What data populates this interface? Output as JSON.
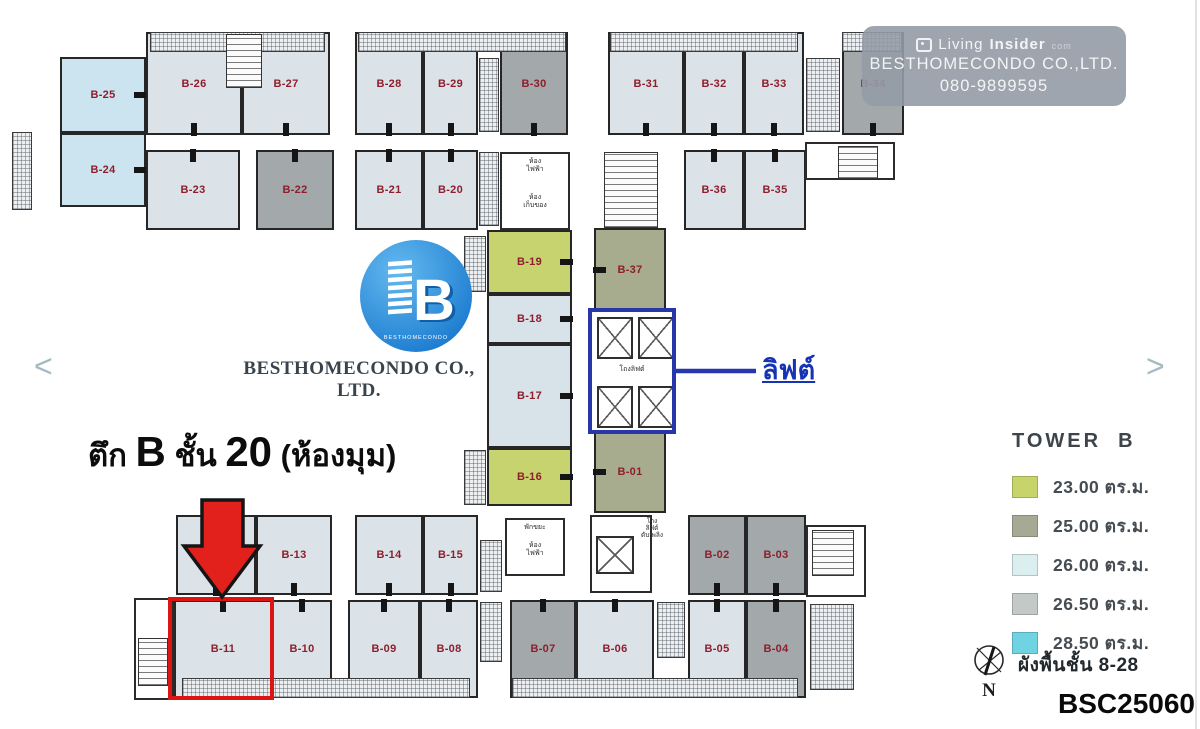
{
  "watermark": {
    "brand_regular": "Living",
    "brand_bold": "Insider",
    "brand_suffix": "com",
    "company": "BESTHOMECONDO CO.,LTD.",
    "phone": "080-9899595"
  },
  "logo": {
    "letter": "B",
    "brand_small": "BESTHOMECONDO",
    "company": "BESTHOMECONDO CO., LTD."
  },
  "heading": {
    "t1": "ตึก ",
    "t2": "B",
    "t3": " ชั้น ",
    "t4": "20",
    "t5": " (ห้องมุม)"
  },
  "elevator_callout": {
    "label": "ลิฟต์"
  },
  "legend": {
    "title": "TOWER  B",
    "items": [
      {
        "color": "#c7d36b",
        "label": "23.00 ตร.ม."
      },
      {
        "color": "#a6aa94",
        "label": "25.00 ตร.ม."
      },
      {
        "color": "#dbeef0",
        "label": "26.00 ตร.ม."
      },
      {
        "color": "#c3c9c7",
        "label": "26.50 ตร.ม."
      },
      {
        "color": "#70d3e2",
        "label": "28.50 ตร.ม."
      }
    ]
  },
  "footer": {
    "compass_n": "N",
    "floor_note": "ผังพื้นชั้น 8-28",
    "code": "BSC25060"
  },
  "nav": {
    "prev": "<",
    "next": ">"
  },
  "plan": {
    "label_color": "#8e1e2d",
    "room_types": {
      "std": "#dce3e8",
      "dark": "#a3a8ab",
      "corner": "#cbe4ef",
      "green": "#c7d36e",
      "olive": "#a7ac8f",
      "pale": "#d8e3e9"
    },
    "rooms": [
      {
        "id": "B-25",
        "x": 60,
        "y": 57,
        "w": 86,
        "h": 76,
        "type": "corner",
        "tick": "r"
      },
      {
        "id": "B-24",
        "x": 60,
        "y": 133,
        "w": 86,
        "h": 74,
        "type": "corner",
        "tick": "r"
      },
      {
        "id": "B-26",
        "x": 146,
        "y": 32,
        "w": 96,
        "h": 103,
        "type": "std",
        "tick": "b"
      },
      {
        "id": "B-27",
        "x": 242,
        "y": 32,
        "w": 88,
        "h": 103,
        "type": "std",
        "tick": "b"
      },
      {
        "id": "B-28",
        "x": 355,
        "y": 32,
        "w": 68,
        "h": 103,
        "type": "std",
        "tick": "b"
      },
      {
        "id": "B-29",
        "x": 423,
        "y": 32,
        "w": 55,
        "h": 103,
        "type": "std",
        "tick": "b"
      },
      {
        "id": "B-30",
        "x": 500,
        "y": 32,
        "w": 68,
        "h": 103,
        "type": "dark",
        "tick": "b"
      },
      {
        "id": "B-31",
        "x": 608,
        "y": 32,
        "w": 76,
        "h": 103,
        "type": "std",
        "tick": "b"
      },
      {
        "id": "B-32",
        "x": 684,
        "y": 32,
        "w": 60,
        "h": 103,
        "type": "std",
        "tick": "b"
      },
      {
        "id": "B-33",
        "x": 744,
        "y": 32,
        "w": 60,
        "h": 103,
        "type": "std",
        "tick": "b"
      },
      {
        "id": "B-34",
        "x": 842,
        "y": 32,
        "w": 62,
        "h": 103,
        "type": "dark",
        "tick": "b"
      },
      {
        "id": "B-23",
        "x": 146,
        "y": 150,
        "w": 94,
        "h": 80,
        "type": "std",
        "tick": "t"
      },
      {
        "id": "B-22",
        "x": 256,
        "y": 150,
        "w": 78,
        "h": 80,
        "type": "dark",
        "tick": "t"
      },
      {
        "id": "B-21",
        "x": 355,
        "y": 150,
        "w": 68,
        "h": 80,
        "type": "std",
        "tick": "t"
      },
      {
        "id": "B-20",
        "x": 423,
        "y": 150,
        "w": 55,
        "h": 80,
        "type": "std",
        "tick": "t"
      },
      {
        "id": "B-36",
        "x": 684,
        "y": 150,
        "w": 60,
        "h": 80,
        "type": "std",
        "tick": "t"
      },
      {
        "id": "B-35",
        "x": 744,
        "y": 150,
        "w": 62,
        "h": 80,
        "type": "std",
        "tick": "t"
      },
      {
        "id": "B-19",
        "x": 487,
        "y": 230,
        "w": 85,
        "h": 64,
        "type": "green",
        "tick": "r"
      },
      {
        "id": "B-18",
        "x": 487,
        "y": 294,
        "w": 85,
        "h": 50,
        "type": "pale",
        "tick": "r"
      },
      {
        "id": "B-17",
        "x": 487,
        "y": 344,
        "w": 85,
        "h": 104,
        "type": "pale",
        "tick": "r"
      },
      {
        "id": "B-16",
        "x": 487,
        "y": 448,
        "w": 85,
        "h": 58,
        "type": "green",
        "tick": "r"
      },
      {
        "id": "B-37",
        "x": 594,
        "y": 228,
        "w": 72,
        "h": 84,
        "type": "olive",
        "tick": "l"
      },
      {
        "id": "B-01",
        "x": 594,
        "y": 430,
        "w": 72,
        "h": 83,
        "type": "olive",
        "tick": "l"
      },
      {
        "id": "B-12",
        "x": 176,
        "y": 515,
        "w": 80,
        "h": 80,
        "type": "std",
        "tick": "b"
      },
      {
        "id": "B-13",
        "x": 256,
        "y": 515,
        "w": 76,
        "h": 80,
        "type": "std",
        "tick": "b"
      },
      {
        "id": "B-14",
        "x": 355,
        "y": 515,
        "w": 68,
        "h": 80,
        "type": "std",
        "tick": "b"
      },
      {
        "id": "B-15",
        "x": 423,
        "y": 515,
        "w": 55,
        "h": 80,
        "type": "std",
        "tick": "b"
      },
      {
        "id": "B-02",
        "x": 688,
        "y": 515,
        "w": 58,
        "h": 80,
        "type": "dark",
        "tick": "b"
      },
      {
        "id": "B-03",
        "x": 746,
        "y": 515,
        "w": 60,
        "h": 80,
        "type": "dark",
        "tick": "b"
      },
      {
        "id": "B-11",
        "x": 174,
        "y": 600,
        "w": 98,
        "h": 98,
        "type": "std",
        "tick": "t"
      },
      {
        "id": "B-10",
        "x": 272,
        "y": 600,
        "w": 60,
        "h": 98,
        "type": "std",
        "tick": "t"
      },
      {
        "id": "B-09",
        "x": 348,
        "y": 600,
        "w": 72,
        "h": 98,
        "type": "std",
        "tick": "t"
      },
      {
        "id": "B-08",
        "x": 420,
        "y": 600,
        "w": 58,
        "h": 98,
        "type": "std",
        "tick": "t"
      },
      {
        "id": "B-07",
        "x": 510,
        "y": 600,
        "w": 66,
        "h": 98,
        "type": "dark",
        "tick": "t"
      },
      {
        "id": "B-06",
        "x": 576,
        "y": 600,
        "w": 78,
        "h": 98,
        "type": "std",
        "tick": "t"
      },
      {
        "id": "B-05",
        "x": 688,
        "y": 600,
        "w": 58,
        "h": 98,
        "type": "std",
        "tick": "t"
      },
      {
        "id": "B-04",
        "x": 746,
        "y": 600,
        "w": 60,
        "h": 98,
        "type": "dark",
        "tick": "t"
      }
    ],
    "areas": [
      {
        "kind": "hatch",
        "x": 150,
        "y": 32,
        "w": 175,
        "h": 20
      },
      {
        "kind": "hatch",
        "x": 358,
        "y": 32,
        "w": 208,
        "h": 20
      },
      {
        "kind": "hatch",
        "x": 610,
        "y": 32,
        "w": 188,
        "h": 20
      },
      {
        "kind": "hatch",
        "x": 842,
        "y": 32,
        "w": 60,
        "h": 20
      },
      {
        "kind": "stairs",
        "x": 226,
        "y": 34,
        "w": 36,
        "h": 54
      },
      {
        "kind": "hatch",
        "x": 12,
        "y": 132,
        "w": 20,
        "h": 78
      },
      {
        "kind": "hatch",
        "x": 479,
        "y": 58,
        "w": 20,
        "h": 74
      },
      {
        "kind": "hatch",
        "x": 479,
        "y": 152,
        "w": 20,
        "h": 74
      },
      {
        "kind": "hatch",
        "x": 806,
        "y": 58,
        "w": 34,
        "h": 74
      },
      {
        "kind": "block",
        "x": 500,
        "y": 152,
        "w": 70,
        "h": 78
      },
      {
        "kind": "stairs",
        "x": 604,
        "y": 152,
        "w": 54,
        "h": 76
      },
      {
        "kind": "block",
        "x": 805,
        "y": 142,
        "w": 90,
        "h": 38
      },
      {
        "kind": "stairs",
        "x": 838,
        "y": 146,
        "w": 40,
        "h": 33
      },
      {
        "kind": "hatch",
        "x": 464,
        "y": 236,
        "w": 22,
        "h": 56
      },
      {
        "kind": "hatch",
        "x": 464,
        "y": 450,
        "w": 22,
        "h": 55
      },
      {
        "kind": "block",
        "x": 590,
        "y": 310,
        "w": 84,
        "h": 122
      },
      {
        "kind": "lift",
        "x": 597,
        "y": 317,
        "w": 36,
        "h": 42
      },
      {
        "kind": "lift",
        "x": 638,
        "y": 317,
        "w": 36,
        "h": 42
      },
      {
        "kind": "lift",
        "x": 597,
        "y": 386,
        "w": 36,
        "h": 42
      },
      {
        "kind": "lift",
        "x": 638,
        "y": 386,
        "w": 36,
        "h": 42
      },
      {
        "kind": "block",
        "x": 505,
        "y": 518,
        "w": 60,
        "h": 58
      },
      {
        "kind": "block",
        "x": 590,
        "y": 515,
        "w": 62,
        "h": 78
      },
      {
        "kind": "lift",
        "x": 596,
        "y": 536,
        "w": 38,
        "h": 38
      },
      {
        "kind": "hatch",
        "x": 480,
        "y": 540,
        "w": 22,
        "h": 52
      },
      {
        "kind": "hatch",
        "x": 480,
        "y": 602,
        "w": 22,
        "h": 60
      },
      {
        "kind": "hatch",
        "x": 657,
        "y": 602,
        "w": 28,
        "h": 56
      },
      {
        "kind": "block",
        "x": 806,
        "y": 525,
        "w": 60,
        "h": 72
      },
      {
        "kind": "stairs",
        "x": 812,
        "y": 530,
        "w": 42,
        "h": 46
      },
      {
        "kind": "hatch",
        "x": 810,
        "y": 604,
        "w": 44,
        "h": 86
      },
      {
        "kind": "block",
        "x": 134,
        "y": 598,
        "w": 40,
        "h": 102
      },
      {
        "kind": "stairs",
        "x": 138,
        "y": 638,
        "w": 30,
        "h": 48
      },
      {
        "kind": "hatch",
        "x": 182,
        "y": 678,
        "w": 288,
        "h": 20
      },
      {
        "kind": "hatch",
        "x": 512,
        "y": 678,
        "w": 286,
        "h": 20
      }
    ],
    "texts": [
      {
        "text": "ห้อง\nไฟฟ้า",
        "x": 500,
        "y": 158,
        "w": 70,
        "size": 7
      },
      {
        "text": "ห้อง\nเก็บของ",
        "x": 500,
        "y": 194,
        "w": 70,
        "size": 7
      },
      {
        "text": "โถงลิฟต์",
        "x": 590,
        "y": 366,
        "w": 84,
        "size": 7
      },
      {
        "text": "พักขยะ",
        "x": 505,
        "y": 524,
        "w": 60,
        "size": 7
      },
      {
        "text": "ห้อง\nไฟฟ้า",
        "x": 505,
        "y": 542,
        "w": 60,
        "size": 7
      },
      {
        "text": "โถง\nลิฟต์\nดับเพลิง",
        "x": 634,
        "y": 518,
        "w": 36,
        "size": 6.5
      }
    ]
  }
}
